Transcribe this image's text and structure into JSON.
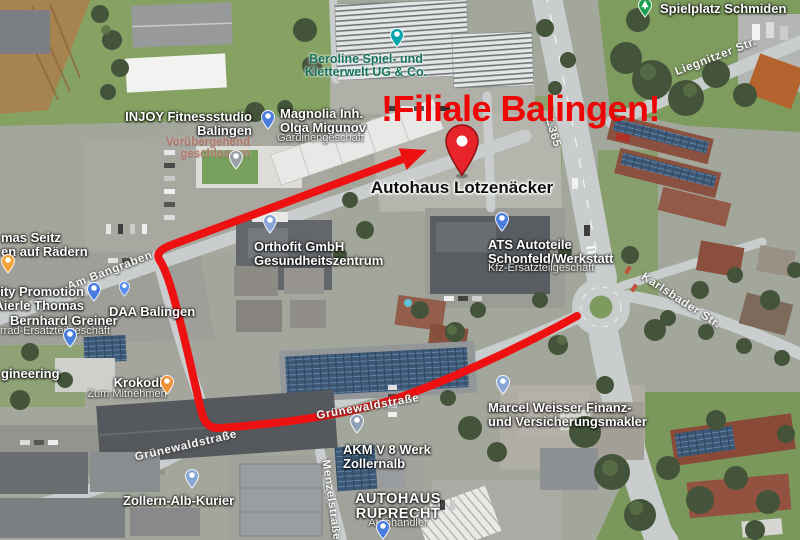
{
  "annotation": {
    "title": "!Filiale Balingen!",
    "title_color": "#ee0606",
    "destination_label": "Autohaus Lotzenäcker",
    "route_color": "#ed1111",
    "pin_color": "#e8242b"
  },
  "label_colors": {
    "poi": "#ffffff",
    "poi-big": "#ffffff",
    "sub": "#ebece8",
    "status": "#b07a6e",
    "street": "#f8f8f5",
    "attraction": "#16745c"
  },
  "map_labels": [
    {
      "name": "spielplatz-schmiden",
      "lines": [
        "Spielplatz Schmiden"
      ],
      "x": 660,
      "y": 2,
      "anchor": "left",
      "style": "poi"
    },
    {
      "name": "liegnitzer-str",
      "lines": [
        "Liegnitzer Str."
      ],
      "x": 716,
      "y": 57,
      "anchor": "center",
      "style": "street",
      "rot": -21
    },
    {
      "name": "beroline",
      "lines": [
        "Beroline Spiel- und",
        "Kletterwelt UG & Co."
      ],
      "x": 366,
      "y": 53,
      "anchor": "center",
      "style": "attraction"
    },
    {
      "name": "injoy",
      "lines": [
        "INJOY Fitnessstudio",
        "Balingen"
      ],
      "x": 252,
      "y": 110,
      "anchor": "right",
      "style": "poi"
    },
    {
      "name": "injoy-status",
      "lines": [
        "Vorübergehend",
        "geschlossen"
      ],
      "x": 250,
      "y": 136,
      "anchor": "right",
      "style": "status"
    },
    {
      "name": "magnolia",
      "lines": [
        "Magnolia Inh.",
        "Olga Migunov"
      ],
      "x": 280,
      "y": 107,
      "anchor": "left",
      "style": "poi"
    },
    {
      "name": "magnolia-sub",
      "lines": [
        "Gardinengeschäft"
      ],
      "x": 277,
      "y": 133,
      "anchor": "left",
      "style": "sub"
    },
    {
      "name": "l365-shield",
      "lines": [
        "L365"
      ],
      "x": 553,
      "y": 133,
      "anchor": "center",
      "style": "street",
      "rot": 74
    },
    {
      "name": "orthofit",
      "lines": [
        "Orthofit GmbH",
        "Gesundheitszentrum"
      ],
      "x": 254,
      "y": 240,
      "anchor": "left",
      "style": "poi"
    },
    {
      "name": "ats",
      "lines": [
        "ATS Autoteile",
        "Schonfeld/Werkstatt"
      ],
      "x": 488,
      "y": 238,
      "anchor": "left",
      "style": "poi"
    },
    {
      "name": "ats-sub",
      "lines": [
        "Kfz-Ersatzteilgeschäft"
      ],
      "x": 488,
      "y": 263,
      "anchor": "left",
      "style": "sub"
    },
    {
      "name": "karlsbader-str",
      "lines": [
        "Karlsbader Str."
      ],
      "x": 681,
      "y": 301,
      "anchor": "center",
      "style": "street",
      "rot": 33
    },
    {
      "name": "seitz",
      "lines": [
        "mas Seitz",
        "en auf Rädern"
      ],
      "x": 1,
      "y": 231,
      "anchor": "left",
      "style": "poi"
    },
    {
      "name": "am-bangraben",
      "lines": [
        "Am Bangraben"
      ],
      "x": 110,
      "y": 271,
      "anchor": "center",
      "style": "street",
      "rot": -21
    },
    {
      "name": "city-promotion",
      "lines": [
        "City Promotion",
        "Aierle Thomas"
      ],
      "x": 84,
      "y": 285,
      "anchor": "right",
      "style": "poi"
    },
    {
      "name": "daa-balingen",
      "lines": [
        "DAA Balingen"
      ],
      "x": 109,
      "y": 305,
      "anchor": "left",
      "style": "poi"
    },
    {
      "name": "bernhard-greiner",
      "lines": [
        "Bernhard Greiner"
      ],
      "x": 10,
      "y": 314,
      "anchor": "left",
      "style": "poi"
    },
    {
      "name": "bernhard-greiner-sub",
      "lines": [
        "rrad-Ersatzteilgeschäft"
      ],
      "x": 0,
      "y": 326,
      "anchor": "left",
      "style": "sub"
    },
    {
      "name": "gineering",
      "lines": [
        "gineering"
      ],
      "x": 1,
      "y": 367,
      "anchor": "left",
      "style": "poi"
    },
    {
      "name": "krokodil",
      "lines": [
        "Krokodil"
      ],
      "x": 140,
      "y": 376,
      "anchor": "center",
      "style": "poi"
    },
    {
      "name": "krokodil-sub",
      "lines": [
        "Zum Mitnehmen"
      ],
      "x": 127,
      "y": 389,
      "anchor": "center",
      "style": "sub"
    },
    {
      "name": "gruenewaldstrasse-1",
      "lines": [
        "Grünewaldstraße"
      ],
      "x": 186,
      "y": 446,
      "anchor": "center",
      "style": "street",
      "rot": -13
    },
    {
      "name": "gruenewaldstrasse-2",
      "lines": [
        "Grünewaldstraße"
      ],
      "x": 368,
      "y": 407,
      "anchor": "center",
      "style": "street",
      "rot": -10
    },
    {
      "name": "menzelstrasse",
      "lines": [
        "Menzelstraße"
      ],
      "x": 331,
      "y": 500,
      "anchor": "center",
      "style": "street",
      "rot": 82
    },
    {
      "name": "akm",
      "lines": [
        "AKM V 8 Werk",
        "Zollernalb"
      ],
      "x": 343,
      "y": 443,
      "anchor": "left",
      "style": "poi"
    },
    {
      "name": "zollern-alb-kurier",
      "lines": [
        "Zollern-Alb-Kurier"
      ],
      "x": 123,
      "y": 494,
      "anchor": "left",
      "style": "poi"
    },
    {
      "name": "autohaus-ruprecht",
      "lines": [
        "AUTOHAUS",
        "RUPRECHT"
      ],
      "x": 398,
      "y": 492,
      "anchor": "center",
      "style": "poi-big"
    },
    {
      "name": "autohaus-ruprecht-sub",
      "lines": [
        "Autohändler"
      ],
      "x": 398,
      "y": 518,
      "anchor": "center",
      "style": "sub"
    },
    {
      "name": "marcel-weisser",
      "lines": [
        "Marcel Weisser Finanz-",
        "und Versicherungsmakler"
      ],
      "x": 488,
      "y": 401,
      "anchor": "left",
      "style": "poi"
    }
  ],
  "markers": [
    {
      "name": "spielplatz-marker",
      "x": 645,
      "y": 6,
      "color": "#1e9e4f",
      "glyph": "tree"
    },
    {
      "name": "beroline-marker",
      "x": 397,
      "y": 36,
      "color": "#00a5ad"
    },
    {
      "name": "magnolia-marker",
      "x": 268,
      "y": 118,
      "color": "#4a7de0"
    },
    {
      "name": "injoy-marker",
      "x": 236,
      "y": 158,
      "color": "#9aa0a6"
    },
    {
      "name": "orthofit-marker",
      "x": 270,
      "y": 222,
      "color": "#88a6d6"
    },
    {
      "name": "ats-marker",
      "x": 502,
      "y": 220,
      "color": "#4a7de0"
    },
    {
      "name": "seitz-marker",
      "x": 8,
      "y": 262,
      "color": "#f2a43b"
    },
    {
      "name": "city-promotion-marker",
      "x": 94,
      "y": 290,
      "color": "#4a7de0"
    },
    {
      "name": "daa-marker",
      "x": 124,
      "y": 287,
      "color": "#5b8cf0",
      "small": true
    },
    {
      "name": "greiner-marker",
      "x": 70,
      "y": 336,
      "color": "#4a7de0"
    },
    {
      "name": "krokodil-marker",
      "x": 167,
      "y": 383,
      "color": "#ef9036"
    },
    {
      "name": "akm-marker",
      "x": 357,
      "y": 422,
      "color": "#8fa0b5"
    },
    {
      "name": "zollern-marker",
      "x": 192,
      "y": 477,
      "color": "#88a6d6"
    },
    {
      "name": "ruprecht-marker",
      "x": 383,
      "y": 528,
      "color": "#4a7de0"
    },
    {
      "name": "marcel-marker",
      "x": 503,
      "y": 383,
      "color": "#88a6d6"
    }
  ]
}
